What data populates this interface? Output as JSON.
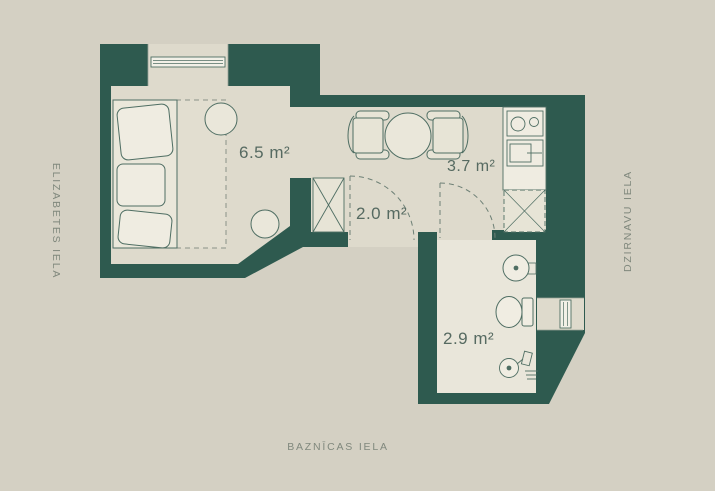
{
  "page": {
    "background": "#d4d0c3"
  },
  "plan": {
    "wall_color": "#2e5a4f",
    "floor_color": "#dedacc",
    "bathroom_floor_color": "#e9e6da",
    "outline_color": "#4f6e63",
    "rooms": [
      {
        "id": "living-room",
        "area_label": "6.5 m²"
      },
      {
        "id": "kitchen-dining",
        "area_label": "3.7 m²"
      },
      {
        "id": "hallway",
        "area_label": "2.0 m²"
      },
      {
        "id": "bathroom",
        "area_label": "2.9 m²"
      }
    ],
    "fixtures": [
      "sofa",
      "daybed-dashed-outline",
      "side-table-round",
      "side-table-round-2",
      "dining-table-round",
      "dining-chair-left",
      "dining-chair-right",
      "cooktop-two-burners",
      "kitchen-sink",
      "kitchen-cabinet-dashed",
      "wardrobe-crossed",
      "entrance-door-swing",
      "bathroom-door-swing",
      "window-top",
      "window-right",
      "wash-basin",
      "toilet",
      "hand-shower-drain"
    ]
  },
  "streets": {
    "left": "ELIZABETES IELA",
    "right": "DZIRNAVU IELA",
    "bottom": "BAZNĪCAS IELA"
  }
}
